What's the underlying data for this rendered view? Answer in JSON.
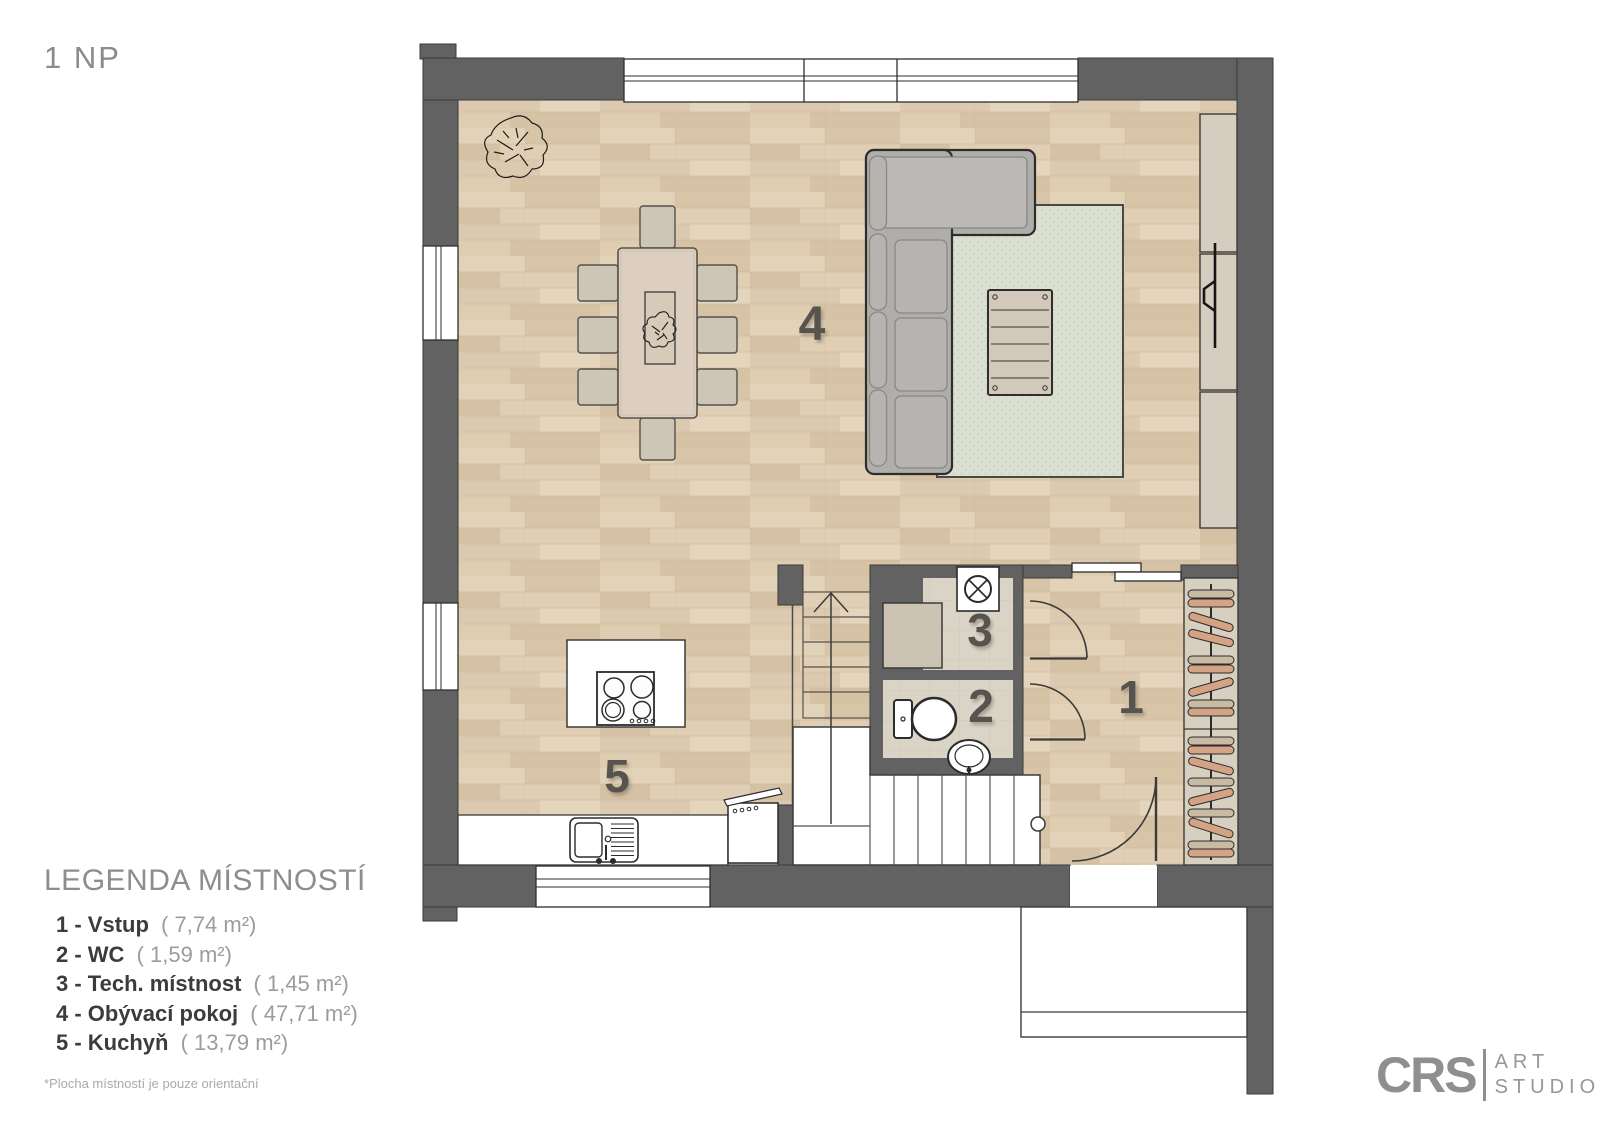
{
  "page": {
    "title": "1 NP"
  },
  "plan": {
    "rooms": [
      {
        "number": "1"
      },
      {
        "number": "2"
      },
      {
        "number": "3"
      },
      {
        "number": "4"
      },
      {
        "number": "5"
      }
    ]
  },
  "legend": {
    "title": "LEGENDA MÍSTNOSTÍ",
    "items": [
      {
        "label": "1 - Vstup",
        "area": "( 7,74 m²)"
      },
      {
        "label": "2 - WC",
        "area": "( 1,59 m²)"
      },
      {
        "label": "3 - Tech. místnost",
        "area": "( 1,45 m²)"
      },
      {
        "label": "4 - Obývací pokoj",
        "area": "( 47,71 m²)"
      },
      {
        "label": "5 - Kuchyň",
        "area": "( 13,79 m²)"
      }
    ],
    "footnote": "*Plocha místností je pouze orientační"
  },
  "logo": {
    "brand": "CRS",
    "art": "ART",
    "studio": "STUDIO"
  },
  "colors": {
    "wall": "#626262",
    "wood": "#ddcbb0",
    "tile": "#dad4c6",
    "rug": "#dbdfd2",
    "outline": "#3a3a38"
  }
}
